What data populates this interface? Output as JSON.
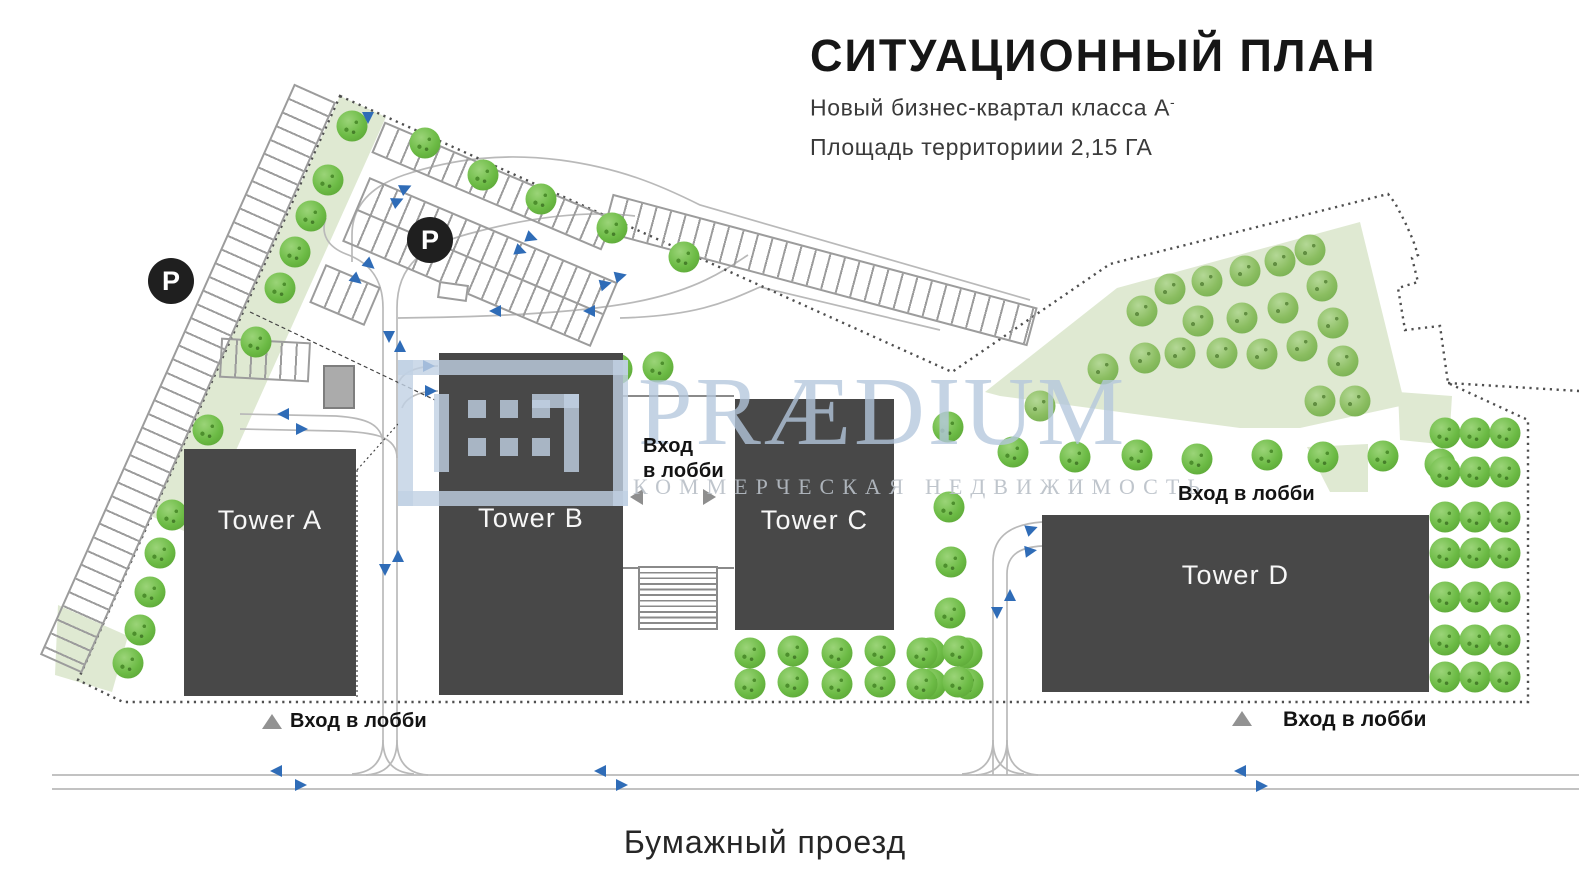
{
  "header": {
    "title": "СИТУАЦИОННЫЙ ПЛАН",
    "subtitle_line1": "Новый бизнес-квартал класса А",
    "subtitle_superscript": "-",
    "subtitle_line2": "Площадь территориии 2,15 ГА"
  },
  "watermark": {
    "brand": "PRÆDIUM",
    "tagline": "КОММЕРЧЕСКАЯ НЕДВИЖИМОСТЬ"
  },
  "towers": [
    {
      "label": "Tower A"
    },
    {
      "label": "Tower B"
    },
    {
      "label": "Tower C"
    },
    {
      "label": "Tower D"
    }
  ],
  "labels": {
    "lobby_entrance": "Вход в лобби",
    "lobby_entrance_line1": "Вход",
    "lobby_entrance_line2": "в лобби",
    "parking_badge": "P",
    "street_name": "Бумажный проезд"
  },
  "colors": {
    "building": "#484848",
    "tree_green": "#6cbb45",
    "lawn_green": "#dfe9d2",
    "arrow_blue": "#2f6cb7",
    "text_dark": "#161616"
  }
}
